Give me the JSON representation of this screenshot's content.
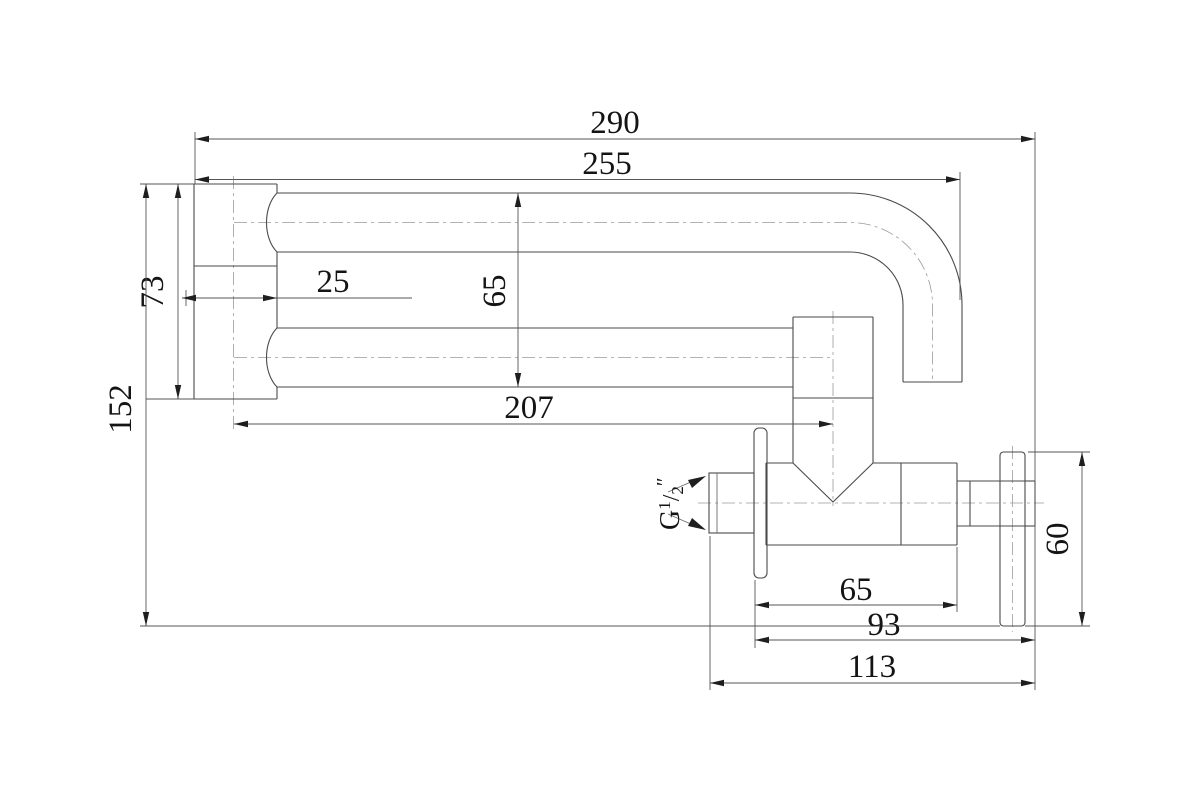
{
  "dims": {
    "overall_width": "290",
    "spout_reach": "255",
    "wall_inset": "25",
    "pipe_drop": "65",
    "block_height": "73",
    "overall_height": "152",
    "lower_pipe_reach": "207",
    "valve_body_length": "65",
    "valve_to_handle": "93",
    "valve_total_length": "113",
    "handle_height": "60"
  },
  "labels": {
    "thread_g": "G",
    "thread_num": "1",
    "thread_slash": "/",
    "thread_den": "2",
    "thread_inch": "″"
  }
}
